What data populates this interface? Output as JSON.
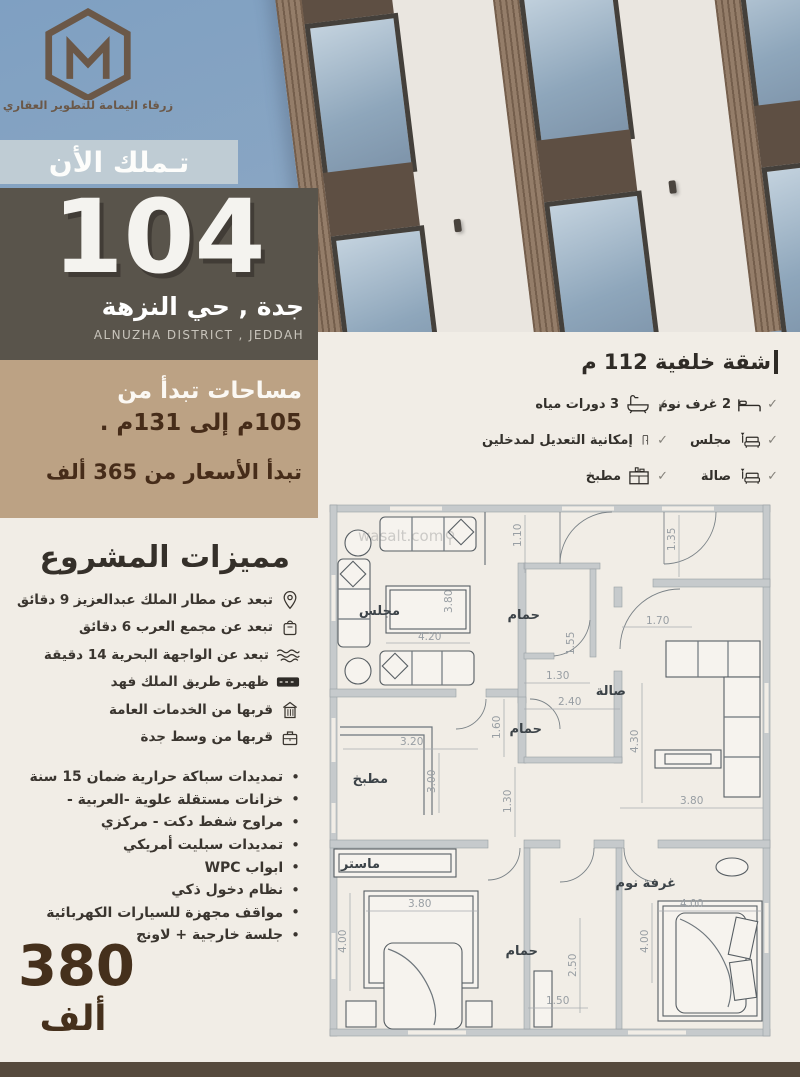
{
  "brand": {
    "name": "زرقاء اليمامة للتطوير العقاري"
  },
  "hero": {
    "own_now": "تـملك الأن",
    "project_number": "104",
    "location_ar": "جدة , حي النزهة",
    "location_en": "ALNUZHA DISTRICT , JEDDAH",
    "areas_line1": "مساحات تبدأ من",
    "areas_line2": "105م إلى  131م .",
    "price_line": "تبدأ الأسعار من 365 ألف"
  },
  "features": {
    "title": "مميزات المشروع",
    "items": [
      {
        "icon": "location-pin-icon",
        "label": "تبعد عن  مطار الملك عبدالعزيز 9 دقائق"
      },
      {
        "icon": "mall-icon",
        "label": "تبعد عن مجمع العرب 6 دقائق"
      },
      {
        "icon": "waves-icon",
        "label": "تبعد عن الواجهة البحرية 14 دقيقة"
      },
      {
        "icon": "road-icon",
        "label": "ظهيرة طريق الملك فهد"
      },
      {
        "icon": "building-icon",
        "label": "قربها من الخدمات العامة"
      },
      {
        "icon": "city-icon",
        "label": "قربها من وسط جدة"
      }
    ],
    "bullets": [
      "تمديدات سباكة حرارية  ضمان 15 سنة",
      "خزانات مستقلة علوية -العربية -",
      "مراوح شفط دكت - مركزي",
      "تمديدات سبليت أمريكي",
      "ابواب WPC",
      "نظام دخول ذكي",
      "مواقف مجهزة للسيارات الكهربائية",
      "جلسة  خارجية + لاونج"
    ]
  },
  "price_badge": {
    "number": "380",
    "unit": "ألف"
  },
  "unit_specs": {
    "title": "شقة خلفية 112 م",
    "right_column": [
      {
        "icon": "bed-icon",
        "label": "2 غرف نوم"
      },
      {
        "icon": "sofa-icon",
        "label": "مجلس"
      },
      {
        "icon": "sofa-icon",
        "label": "صالة"
      }
    ],
    "left_column": [
      {
        "icon": "bathtub-icon",
        "label": "3 دورات مياه"
      },
      {
        "icon": "door-icon",
        "label": "إمكانية التعديل لمدخلين"
      },
      {
        "icon": "kitchen-icon",
        "label": "مطبخ"
      }
    ],
    "check_glyph": "✓"
  },
  "floor_plan": {
    "watermark": "wasalt.com",
    "rooms": {
      "majlis": "مجلس",
      "bath_top": "حمام",
      "hall": "صالة",
      "bath_mid": "حمام",
      "kitchen": "مطبخ",
      "master_closet": "ماستر",
      "bath_bottom": "حمام",
      "bedroom": "غرفة نوم"
    },
    "dims": [
      "1.10",
      "1.35",
      "3.80",
      "4.20",
      "1.70",
      "1.55",
      "1.30",
      "2.40",
      "1.60",
      "3.20",
      "3.00",
      "1.30",
      "4.30",
      "3.80",
      "3.80",
      "4.00",
      "4.00",
      "4.00",
      "2.50",
      "1.50"
    ]
  },
  "colors": {
    "sky": "#84a3c3",
    "banner": "#bfccd4",
    "dark_box": "#59544b",
    "beige_box": "#bca284",
    "cream": "#f1ede6",
    "text_brown": "#462c19",
    "footer_bar": "#564a3d"
  }
}
